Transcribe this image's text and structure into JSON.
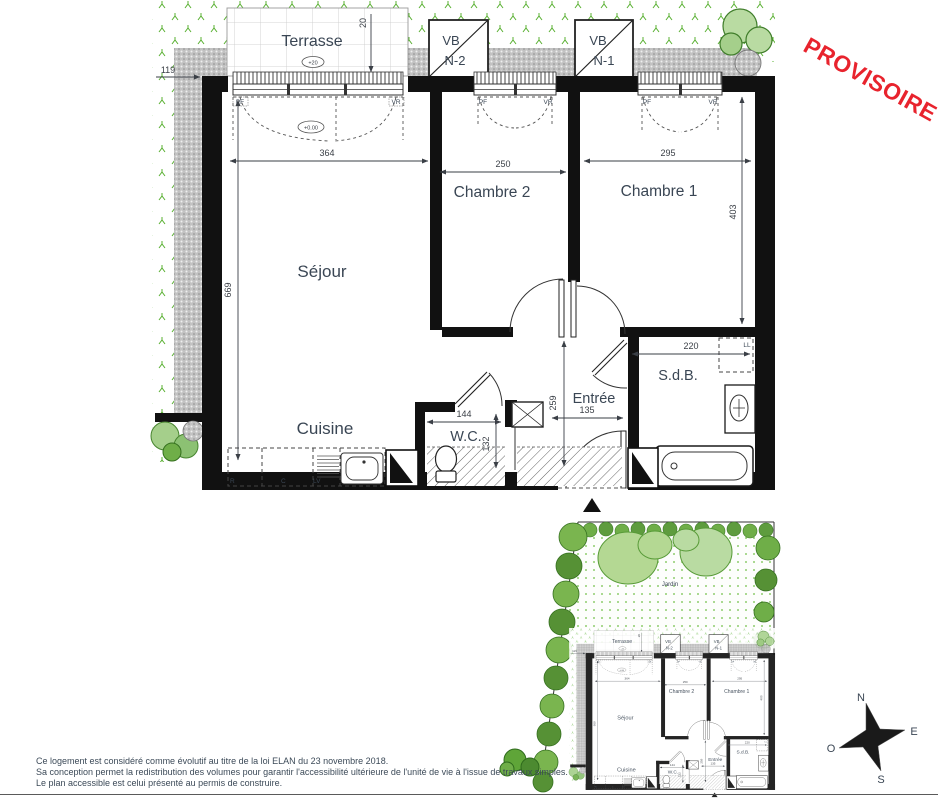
{
  "stamp": {
    "label": "PROVISOIRE",
    "color": "#e8232d"
  },
  "plan": {
    "rooms": {
      "terrasse": "Terrasse",
      "sejour": "Séjour",
      "chambre2": "Chambre 2",
      "chambre1": "Chambre 1",
      "cuisine": "Cuisine",
      "wc": "W.C.",
      "entree": "Entrée",
      "sdb": "S.d.B."
    },
    "dims": {
      "d119": "119",
      "d20": "20",
      "d364": "364",
      "d250": "250",
      "d295": "295",
      "d669": "669",
      "d403": "403",
      "d220": "220",
      "d144": "144",
      "d132": "132",
      "d135": "135",
      "d259": "259"
    },
    "levels": {
      "terrasse": "+20",
      "sejour": "+0.00"
    },
    "tags": {
      "pf": "PF",
      "vr": "VR",
      "r": "R",
      "c": "C",
      "lv": "LV",
      "ll": "LL"
    },
    "vb": {
      "vb": "VB",
      "n2": "N-2",
      "n1": "N-1"
    }
  },
  "site": {
    "jardin": "Jardin"
  },
  "compass": {
    "n": "N",
    "e": "E",
    "s": "S",
    "o": "O"
  },
  "footer": {
    "lines": [
      "Ce logement est considéré comme évolutif au titre de la loi ELAN du 23 novembre 2018.",
      "Sa conception permet la redistribution des volumes pour garantir l'accessibilité ultérieure de l'unité de vie à l'issue de travaux simples.",
      "Le plan accessible est celui présenté au permis de construire."
    ]
  }
}
